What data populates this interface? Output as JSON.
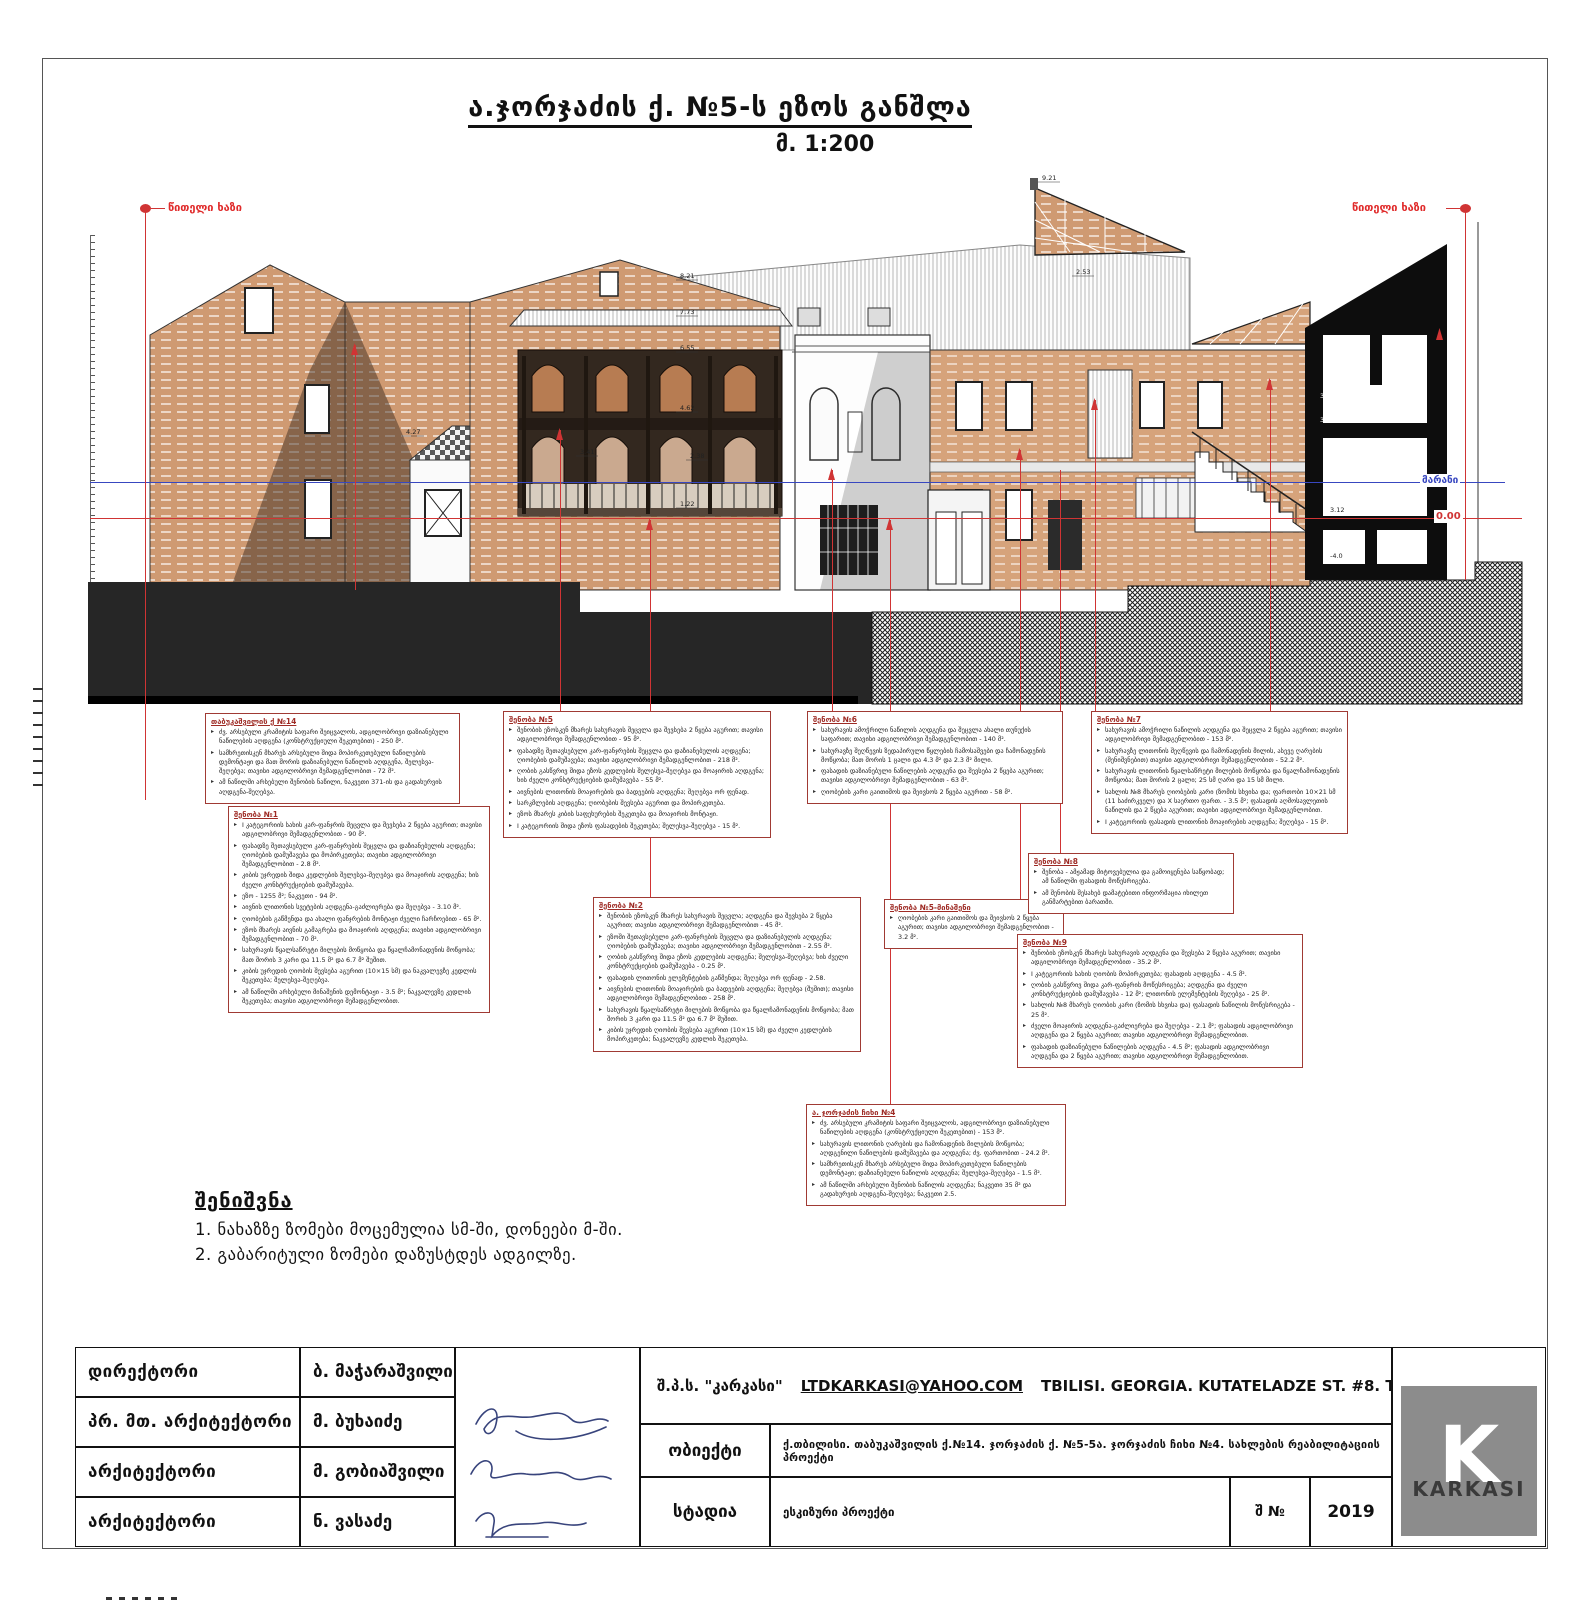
{
  "sheet": {
    "title": "ა.ჯორჯაძის ქ. №5-ს ეზოს განშლა",
    "scale": "მ. 1:200",
    "red_line_label_left": "წითელი ხაზი",
    "red_line_label_right": "წითელი ხაზი",
    "level_label_marani": "მარანი",
    "level_label_zero": "0.00"
  },
  "drawing": {
    "marks": [
      "8.21",
      "7.73",
      "6.55",
      "4.62",
      "4.27",
      "3.41",
      "2.38",
      "1.22",
      "9.21",
      "2.53",
      "3.24",
      "3.84",
      "3.12",
      "-4.0"
    ]
  },
  "notes": {
    "title": "შენიშვნა",
    "items": [
      "1. ნახაზზე ზომები მოცემულია სმ-ში, დონეები მ-ში.",
      "2. გაბარიტული ზომები დაზუსტდეს ადგილზე."
    ]
  },
  "annotations": {
    "boxA": {
      "title": "თაბუკაშვილის ქ №14",
      "bullets": [
        "ძვ. არსებული კრამიტის საფარი შეიცვალოს, ადგილობრივი დაზიანებული ნაწილების აღდგენა (კონსტრუქციული შეკეთებით) - 250 მ².",
        "სამხრეთისკენ მხარეს არსებული შიდა მოპირკეთებული ნაწილების დემონტაჟი და მათ შორის დაზიანებული ნაწილის აღდგენა, შელესვა-შეღებვა; თავისი ადგილობრივი შემადგენლობით - 72 მ².",
        "ამ ნაწილში არსებული შენობის ნაწილი, ნაკვეთი 371-ის და გადახურვის აღდგენა-შეღებვა."
      ]
    },
    "boxB": {
      "title": "შენობა №1",
      "bullets": [
        "I კატეგორიის სახის კარ-ფანჯრის შეცვლა და შევსება 2 წყება აგურით; თავისი ადგილობრივი შემადგენლობით - 90 მ².",
        "ფასადზე შეთავსებული კარ-ფანჯრების შეცვლა და დაზიანებულის აღდგენა; ღიობების დამუშავება და მოპირკეთება; თავისი ადგილობრივი შემადგენლობით - 2.8 მ².",
        "კიბის უჯრედის შიდა კედლების შელესვა-შეღებვა და მოაჯირის აღდგენა; ხის ძველი კონსტრუქციების დამუშავება.",
        "ეზო - 1255 მ²; ნაკვეთი - 94 მ².",
        "აივნის ლითონის სვეტების აღდგენა-გაძლიერება და შეღებვა - 3.10 მ².",
        "ღიობების გაწმენდა და ახალი ფანჯრების მონტაჟი ძველი ჩარჩოებით - 65 მ².",
        "ეზოს მხარეს აივნის გამაგრება და მოაჯირის აღდგენა; თავისი ადგილობრივი შემადგენლობით - 70 მ².",
        "სახურავის წყალსაწრეტი მილების მოწყობა და წყალჩამონადენის მოწყობა; მათ შორის 3 კარი და 11.5 მ² და 6.7 მ² შუშით.",
        "კიბის უჯრედის ღიობის შევსება აგურით (10×15 სმ) და ნაკვალევზე კედლის შეკეთება; შელესვა-შეღებვა.",
        "ამ ნაწილში არსებული მინაშენის დემონტაჟი - 3.5 მ²; ნაკვალევზე კედლის შეკეთება; თავისი ადგილობრივი შემადგენლობით."
      ]
    },
    "boxC": {
      "title": "შენობა №5",
      "bullets": [
        "შენობის ეზოსკენ მხარეს სახურავის შეცვლა და შევსება 2 წყება აგურით; თავისი ადგილობრივი შემადგენლობით - 95 მ².",
        "ფასადზე შეთავსებული კარ-ფანჯრების შეცვლა და დაზიანებულის აღდგენა; ღიობების დამუშავება; თავისი ადგილობრივი შემადგენლობით - 218 მ².",
        "ღობის გასწვრივ შიდა ეზოს კედლების შელესვა-შეღებვა და მოაჯირის აღდგენა; ხის ძველი კონსტრუქციების დამუშავება - 55 მ².",
        "აივნების ლითონის მოაჯირების და ბადეების აღდგენა; შეღებვა ორ ფენად.",
        "სარკმლების აღდგენა; ღიობების შევსება აგურით და მოპირკეთება.",
        "ეზოს მხარეს კიბის საფეხურების შეკეთება და მოაჯირის მონტაჟი.",
        "I კატეგორიის შიდა ეზოს ფასადების შეკეთება; შელესვა-შეღებვა - 15 მ²."
      ]
    },
    "boxD": {
      "title": "შენობა №2",
      "bullets": [
        "შენობის ეზოსკენ მხარეს სახურავის შეცვლა; აღდგენა და შევსება 2 წყება აგურით; თავისი ადგილობრივი შემადგენლობით - 45 მ².",
        "ეზოში შეთავსებული კარ-ფანჯრების შეცვლა და დაზიანებულის აღდგენა; ღიობების დამუშავება; თავისი ადგილობრივი შემადგენლობით - 2.55 მ².",
        "ღობის გასწვრივ შიდა ეზოს კედლების აღდგენა; შელესვა-შეღებვა; ხის ძველი კონსტრუქციების დამუშავება - 0.25 მ².",
        "ფასადის ლითონის ელემენტების გაწმენდა; შეღებვა ორ ფენად - 2.58.",
        "აივნების ლითონის მოაჯირების და ბადეების აღდგენა; შეღებვა (შუშით); თავისი ადგილობრივი შემადგენლობით - 258 მ².",
        "სახურავის წყალსაწრეტი მილების მოწყობა და წყალჩამონადენის მოწყობა; მათ შორის 3 კარი და 11.5 მ² და 6.7 მ² შუშით.",
        "კიბის უჯრედის ღიობის შევსება აგურით (10×15 სმ) და ძველი კედლების მოპირკეთება; ნაკვალევზე კედლის შეკეთება."
      ]
    },
    "boxE": {
      "title": "შენობა №6",
      "bullets": [
        "სახურავის ამოჭრილი ნაწილის აღდგენა და შეცვლა ახალი თუნუქის საფარით; თავისი ადგილობრივი შემადგენლობით - 140 მ².",
        "სახურავზე შეღწევის ზედაპირული წყლების ჩამოსაშვები და ჩამონადენის მოწყობა; მათ შორის 1 ცალი და 4.3 მ² და 2.3 მ² მილი.",
        "ფასადის დაზიანებული ნაწილების აღდგენა და შევსება 2 წყება აგურით; თავისი ადგილობრივი შემადგენლობით - 63 მ².",
        "ღიობების კარი გაითიშოს და შეივსოს 2 წყება აგურით - 58 მ²."
      ]
    },
    "boxF": {
      "title": "შენობა №5-მინაშენი",
      "bullets": [
        "ღიობების კარი გაითიშოს და შეივსოს 2 წყება აგურით; თავისი ადგილობრივი შემადგენლობით - 3.2 მ²."
      ]
    },
    "boxG": {
      "title": "შენობა №7",
      "bullets": [
        "სახურავის ამოჭრილი ნაწილის აღდგენა და შეცვლა 2 წყება აგურით; თავისი ადგილობრივი შემადგენლობით - 153 მ².",
        "სახურავზე ლითონის შეღწევის და ჩამონადენის მილის, ასევე ღარების (შენიშვნებით) თავისი ადგილობრივი შემადგენლობით - 52.2 მ².",
        "სახურავის ლითონის წყალსაწრეტი მილების მოწყობა და წყალჩამონადენის მოწყობა; მათ შორის 2 ცალი; 25 სმ ღარი და 15 სმ მილი.",
        "სახლის №8 მხარეს ღიობების კარი (ზომის სხვისა და; ფართობი 10×21 სმ (11 საძირკველ) და X საერთო ფართ. - 3.5 მ²; ფასადის აღმოსავლეთის ნაწილის და 2 წყება აგურით; თავისი ადგილობრივი შემადგენლობით.",
        "I კატეგორიის ფასადის ლითონის მოაჯირების აღდგენა; შეღებვა - 15 მ²."
      ]
    },
    "boxH": {
      "title": "შენობა №8",
      "bullets": [
        "შენობა - ამჟამად მიტოვებულია და გამოიყენება საწყობად; ამ ნაწილში ფასადის მოწესრიგება.",
        "ამ შენობის შესახებ დამატებითი ინფორმაცია იხილეთ განმარტებით ბარათში."
      ]
    },
    "boxI": {
      "title": "შენობა №9",
      "bullets": [
        "შენობის ეზოსკენ მხარეს სახურავის აღდგენა და შევსება 2 წყება აგურით; თავისი ადგილობრივი შემადგენლობით - 35.2 მ².",
        "I კატეგორიის სახის ღიობის მოპირკეთება; ფასადის აღდგენა - 4.5 მ².",
        "ღობის გასწვრივ შიდა კარ-ფანჯრის მოწესრიგება; აღდგენა და ძველი კონსტრუქციების დამუშავება - 12 მ²; ლითონის ელემენტების შეღებვა - 25 მ².",
        "სახლის №8 მხარეს ღიობის კარი (ზომის სხვისა და) ფასადის ნაწილის მოწესრიგება - 25 მ².",
        "ძველი მოაჯირის აღდგენა-გაძლიერება და შეღებვა - 2.1 მ²; ფასადის ადგილობრივი აღდგენა და 2 წყება აგურით; თავისი ადგილობრივი შემადგენლობით.",
        "ფასადის დაზიანებული ნაწილების აღდგენა - 4.5 მ²; ფასადის ადგილობრივი აღდგენა და 2 წყება აგურით; თავისი ადგილობრივი შემადგენლობით."
      ]
    },
    "boxJ": {
      "title": "ა. ჯორჯაძის ჩიხი №4",
      "bullets": [
        "ძვ. არსებული კრამიტის საფარი შეიცვალოს, ადგილობრივი დაზიანებული ნაწილების აღდგენა (კონსტრუქციული შეკეთებით) - 153 მ².",
        "სახურავის ლითონის ღარების და ჩამონადენის მილების მოწყობა; აღდგენილი ნაწილების დამუშავება და აღდგენა; ძვ. ფართობით - 24.2 მ².",
        "სამხრეთისკენ მხარეს არსებული შიდა მოპირკეთებული ნაწილების დემონტაჟი; დაზიანებული ნაწილის აღდგენა; შელესვა-შეღებვა - 1.5 მ².",
        "ამ ნაწილში არსებული შენობის ნაწილის აღდგენა; ნაკვეთი 35 მ² და გადახურვის აღდგენა-შეღებვა; ნაკვეთი 2.5."
      ]
    }
  },
  "titleblock": {
    "rows": [
      {
        "role": "დირექტორი",
        "name": "ბ. მაჭარაშვილი"
      },
      {
        "role": "პრ. მთ. არქიტექტორი",
        "name": "მ. ბუხაიძე"
      },
      {
        "role": "არქიტექტორი",
        "name": "მ. გობიაშვილი"
      },
      {
        "role": "არქიტექტორი",
        "name": "ნ. ვასაძე"
      }
    ],
    "company": "შ.პ.ს. \"კარკასი\"",
    "email": "LTDKARKASI@YAHOO.COM",
    "address": "TBILISI. GEORGIA. KUTATELADZE ST. #8. T. 593 144226\"",
    "object_label": "ობიექტი",
    "object_value": "ქ.თბილისი. თაბუკაშვილის ქ.№14. ჯორჯაძის ქ. №5-5ა. ჯორჯაძის ჩიხი №4. სახლების რეაბილიტაციის პროექტი",
    "stage_label": "სტადია",
    "stage_value": "ესკიზური პროექტი",
    "sheet_label": "შ №",
    "year": "2019",
    "logo_letter": "K",
    "logo_text": "KARKASI"
  }
}
